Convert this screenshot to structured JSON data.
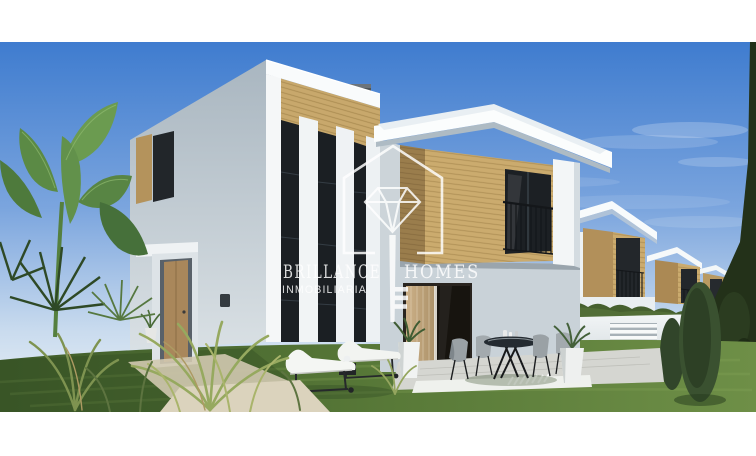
{
  "watermark": {
    "brand": {
      "primary": "BRILLANCE",
      "secondary": "HOMES",
      "tagline": "INMOBILIARIA"
    },
    "logo": {
      "parts": [
        "house-outline-icon",
        "diamond-icon",
        "key-icon"
      ],
      "color": "#ffffff",
      "opacity": 0.84
    }
  },
  "photo": {
    "frame_color": "#ffffff",
    "scene_colors": {
      "sky_top": "#3f7ccf",
      "sky_horizon": "#e9f0f7",
      "wall_lit": "#f4f6f7",
      "wall_shadow": "#b3bfc8",
      "wood_lit": "#c8a86c",
      "wood_shadow": "#9a7d4c",
      "window_glass": "#1b1f23",
      "grass_dark": "#42602c",
      "grass_light": "#6e8f47",
      "hedge": "#46602f",
      "terrace": "#d5d6d1",
      "curtain": "#c3a87e"
    }
  }
}
